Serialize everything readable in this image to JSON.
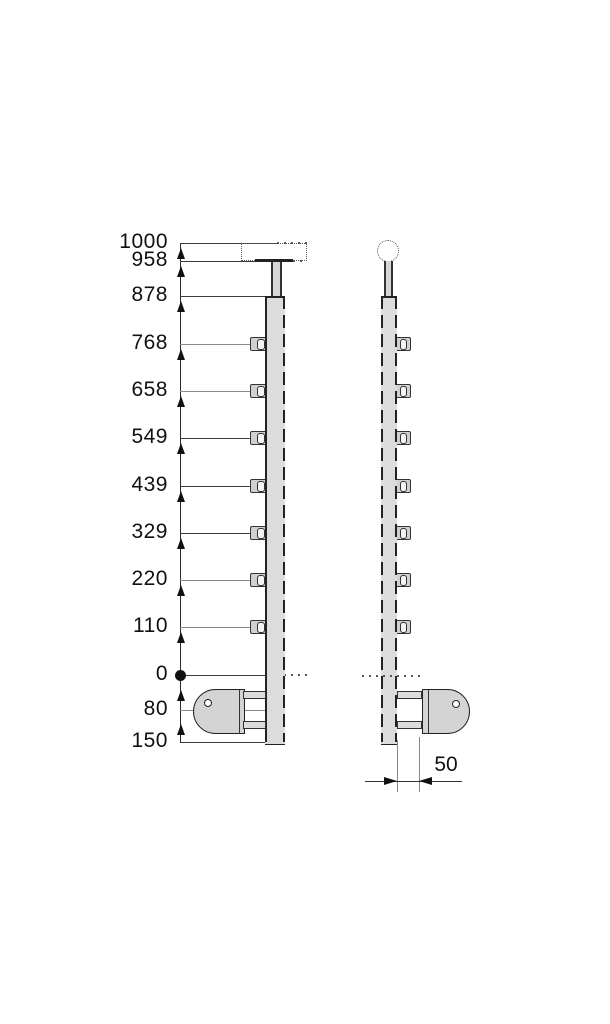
{
  "drawing": {
    "levels": [
      {
        "label": "1000",
        "value": 1000
      },
      {
        "label": "958",
        "value": 958
      },
      {
        "label": "878",
        "value": 878
      },
      {
        "label": "768",
        "value": 768
      },
      {
        "label": "658",
        "value": 658
      },
      {
        "label": "549",
        "value": 549
      },
      {
        "label": "439",
        "value": 439
      },
      {
        "label": "329",
        "value": 329
      },
      {
        "label": "220",
        "value": 220
      },
      {
        "label": "110",
        "value": 110
      },
      {
        "label": "0",
        "value": 0
      },
      {
        "label": "80",
        "value": 80
      },
      {
        "label": "150",
        "value": 150
      }
    ],
    "width_dimension": {
      "label": "50",
      "value": 50
    },
    "colors": {
      "line": "#2a2a2a",
      "part_fill": "#dcdcdc",
      "background": "#ffffff"
    }
  }
}
